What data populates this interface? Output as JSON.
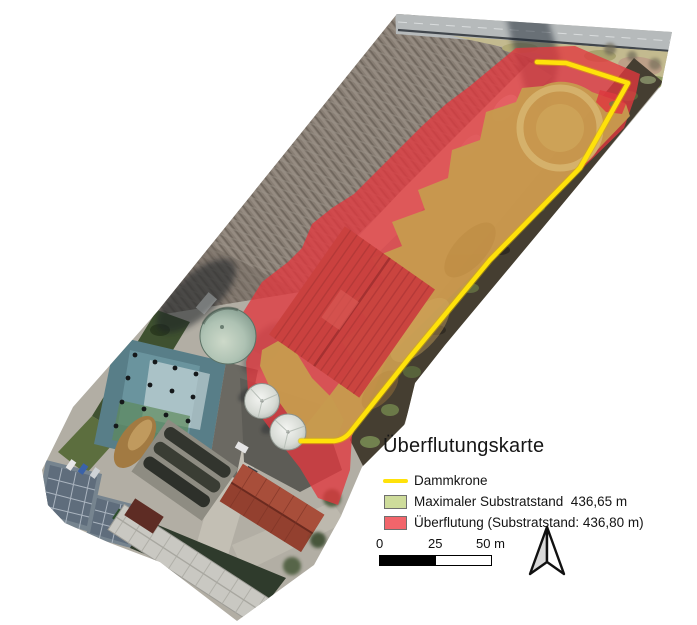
{
  "map": {
    "title": "Überflutungskarte",
    "legend": {
      "items": [
        {
          "label": "Dammkrone",
          "swatch": "line",
          "color": "#ffe20a"
        },
        {
          "label": "Maximaler Substratstand  436,65 m",
          "swatch": "area",
          "color": "#cedc9b"
        },
        {
          "label": "Überflutung (Substratstand: 436,80 m)",
          "swatch": "area",
          "color": "#f2656b"
        }
      ]
    },
    "scalebar": {
      "tick0": "0",
      "tick25": "25",
      "tick50": "50 m"
    },
    "icons": {
      "north_arrow": "north-arrow"
    },
    "overlay_colors": {
      "dammkrone_line": "#ffe20a",
      "flood_fill": "#e2393f",
      "substrate_fill": "#c79a4e"
    }
  }
}
